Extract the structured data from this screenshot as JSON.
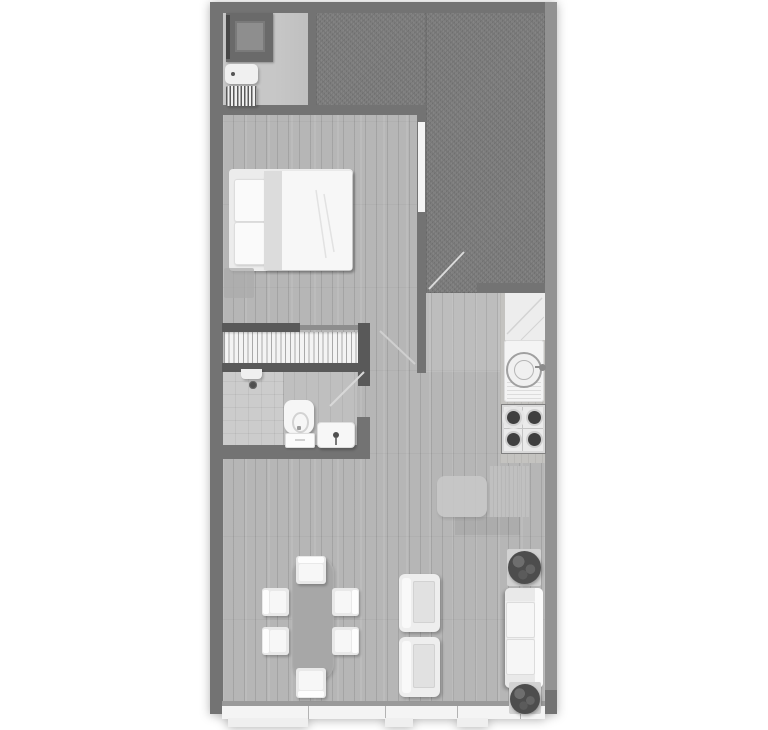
{
  "image": {
    "kind": "architectural-floor-plan-top-view",
    "style": "grayscale render",
    "background": "#ffffff"
  },
  "theme": {
    "wall": "#737373",
    "wall_dark": "#595959",
    "wall_light": "#929292",
    "floor_wood": "#b6b6b6",
    "floor_utility": "#c7c7c7",
    "floor_bath": "#bfbfbf",
    "floor_shower": "#cccccc",
    "terrace": "#7d7d7d",
    "glass": "#f4f4f4",
    "furniture": "#f0f0f0",
    "table": "#a7a7a7",
    "foliage": "#4d4d4d",
    "fixture_dark": "#3f3f3f"
  },
  "rooms": [
    {
      "name": "utility-room",
      "position": "top-left",
      "items": [
        "washing-machine",
        "boiler",
        "vent-unit"
      ]
    },
    {
      "name": "terrace",
      "position": "top-right",
      "items": [
        "terrace-door-swing"
      ]
    },
    {
      "name": "bedroom",
      "position": "upper-left",
      "items": [
        "double-bed",
        "pillow",
        "pillow",
        "duvet",
        "bedside-bench",
        "window-right-wall"
      ]
    },
    {
      "name": "staircase",
      "position": "middle-left",
      "items": [
        "stair-treads",
        "handrails"
      ]
    },
    {
      "name": "bathroom",
      "position": "middle-left-below-stairs",
      "items": [
        "shower",
        "shower-drain",
        "toilet",
        "washbasin",
        "door-swing"
      ]
    },
    {
      "name": "kitchen",
      "position": "middle-right",
      "items": [
        "worktop",
        "round-sink",
        "gas-hob-4-burners"
      ]
    },
    {
      "name": "living-dining",
      "position": "bottom",
      "items": [
        "dining-table",
        "chair",
        "chair",
        "chair",
        "chair",
        "chair",
        "chair",
        "armchair",
        "armchair",
        "sofa",
        "plant",
        "plant",
        "desk",
        "rug",
        "south-window-band",
        "window-sills"
      ]
    }
  ],
  "doors": [
    "terrace-door",
    "hallway-door",
    "bathroom-door"
  ],
  "windows": [
    "bedroom-right-window",
    "south-glazing-band"
  ]
}
